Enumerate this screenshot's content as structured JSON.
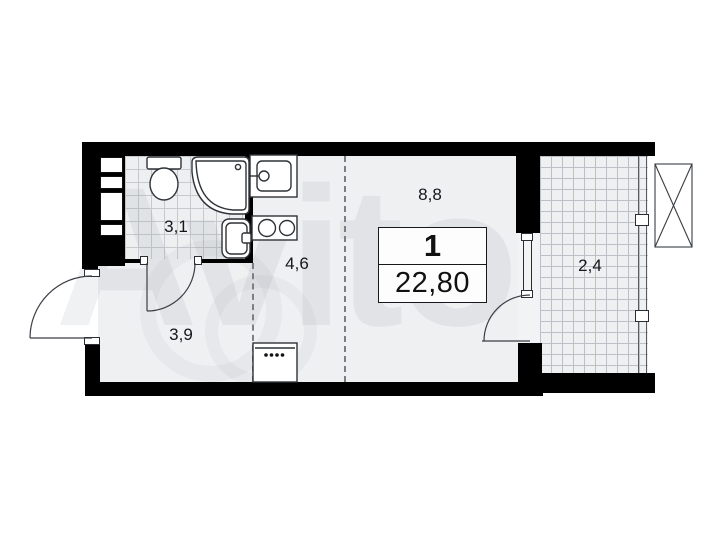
{
  "floorplan": {
    "unit": {
      "rooms_count": "1",
      "total_area": "22,80"
    },
    "rooms": [
      {
        "id": "bathroom",
        "area_label": "3,1"
      },
      {
        "id": "kitchen",
        "area_label": "4,6"
      },
      {
        "id": "living",
        "area_label": "8,8"
      },
      {
        "id": "hall",
        "area_label": "3,9"
      },
      {
        "id": "balcony",
        "area_label": "2,4"
      }
    ],
    "watermark": "Avito",
    "colors": {
      "wall": "#000000",
      "floor": "#eef0f2",
      "tile_grid": "#c6c9ce",
      "balcony_grid": "#bdc1c7",
      "line": "#2f3237",
      "text": "#15161a"
    }
  }
}
